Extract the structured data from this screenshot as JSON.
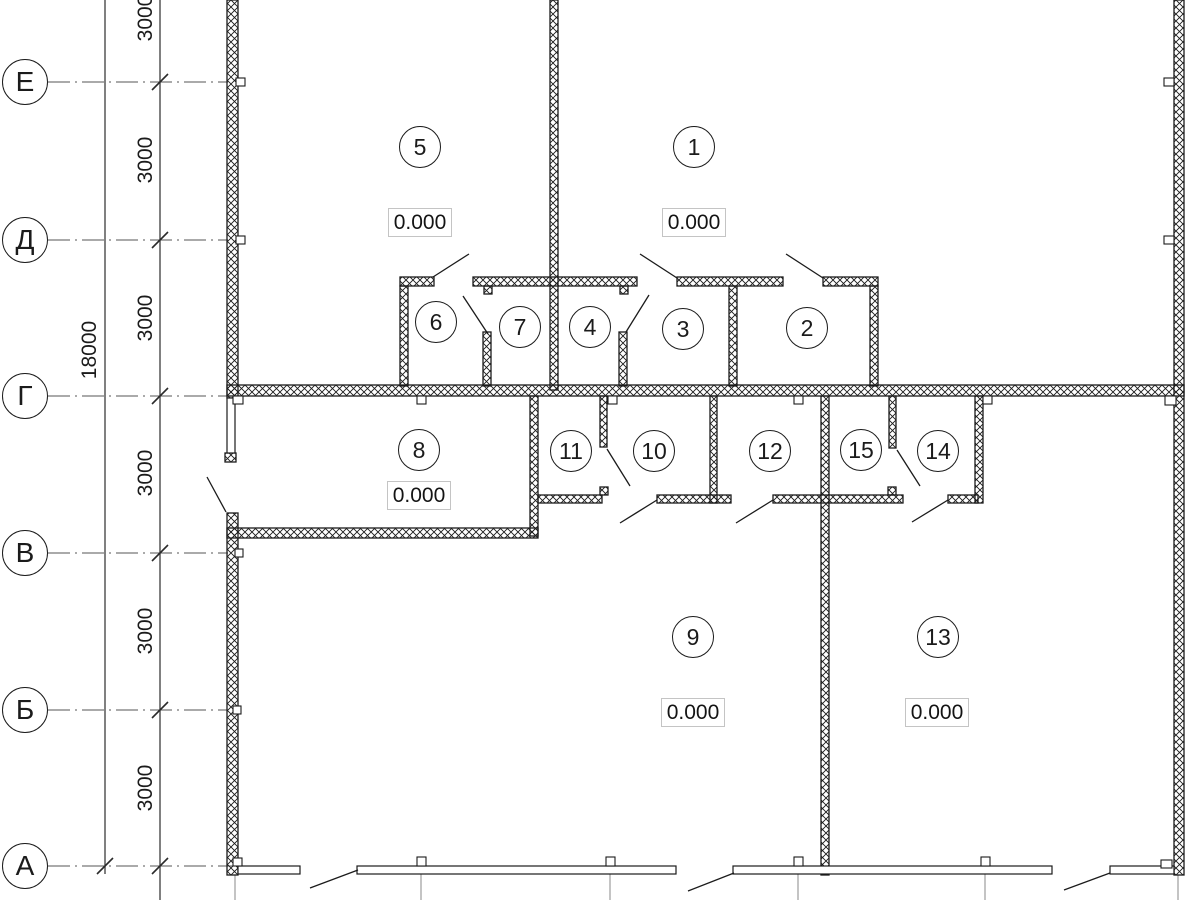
{
  "drawing": {
    "axes": {
      "rows": [
        {
          "label": "Е"
        },
        {
          "label": "Д"
        },
        {
          "label": "Г"
        },
        {
          "label": "В"
        },
        {
          "label": "Б"
        },
        {
          "label": "А"
        }
      ]
    },
    "dimensions": {
      "total": "18000",
      "bays": [
        "3000",
        "3000",
        "3000",
        "3000",
        "3000",
        "3000"
      ]
    },
    "rooms": [
      {
        "number": "5",
        "elevation": "0.000"
      },
      {
        "number": "1",
        "elevation": "0.000"
      },
      {
        "number": "6"
      },
      {
        "number": "7"
      },
      {
        "number": "4"
      },
      {
        "number": "3"
      },
      {
        "number": "2"
      },
      {
        "number": "8",
        "elevation": "0.000"
      },
      {
        "number": "11"
      },
      {
        "number": "10"
      },
      {
        "number": "12"
      },
      {
        "number": "15"
      },
      {
        "number": "14"
      },
      {
        "number": "9",
        "elevation": "0.000"
      },
      {
        "number": "13",
        "elevation": "0.000"
      }
    ],
    "colors": {
      "line": "#1b1b1b",
      "dim_line": "#4a4a4a",
      "axis_line": "#555555",
      "elevation_box_border": "#c4c4c4",
      "background": "#ffffff"
    }
  }
}
